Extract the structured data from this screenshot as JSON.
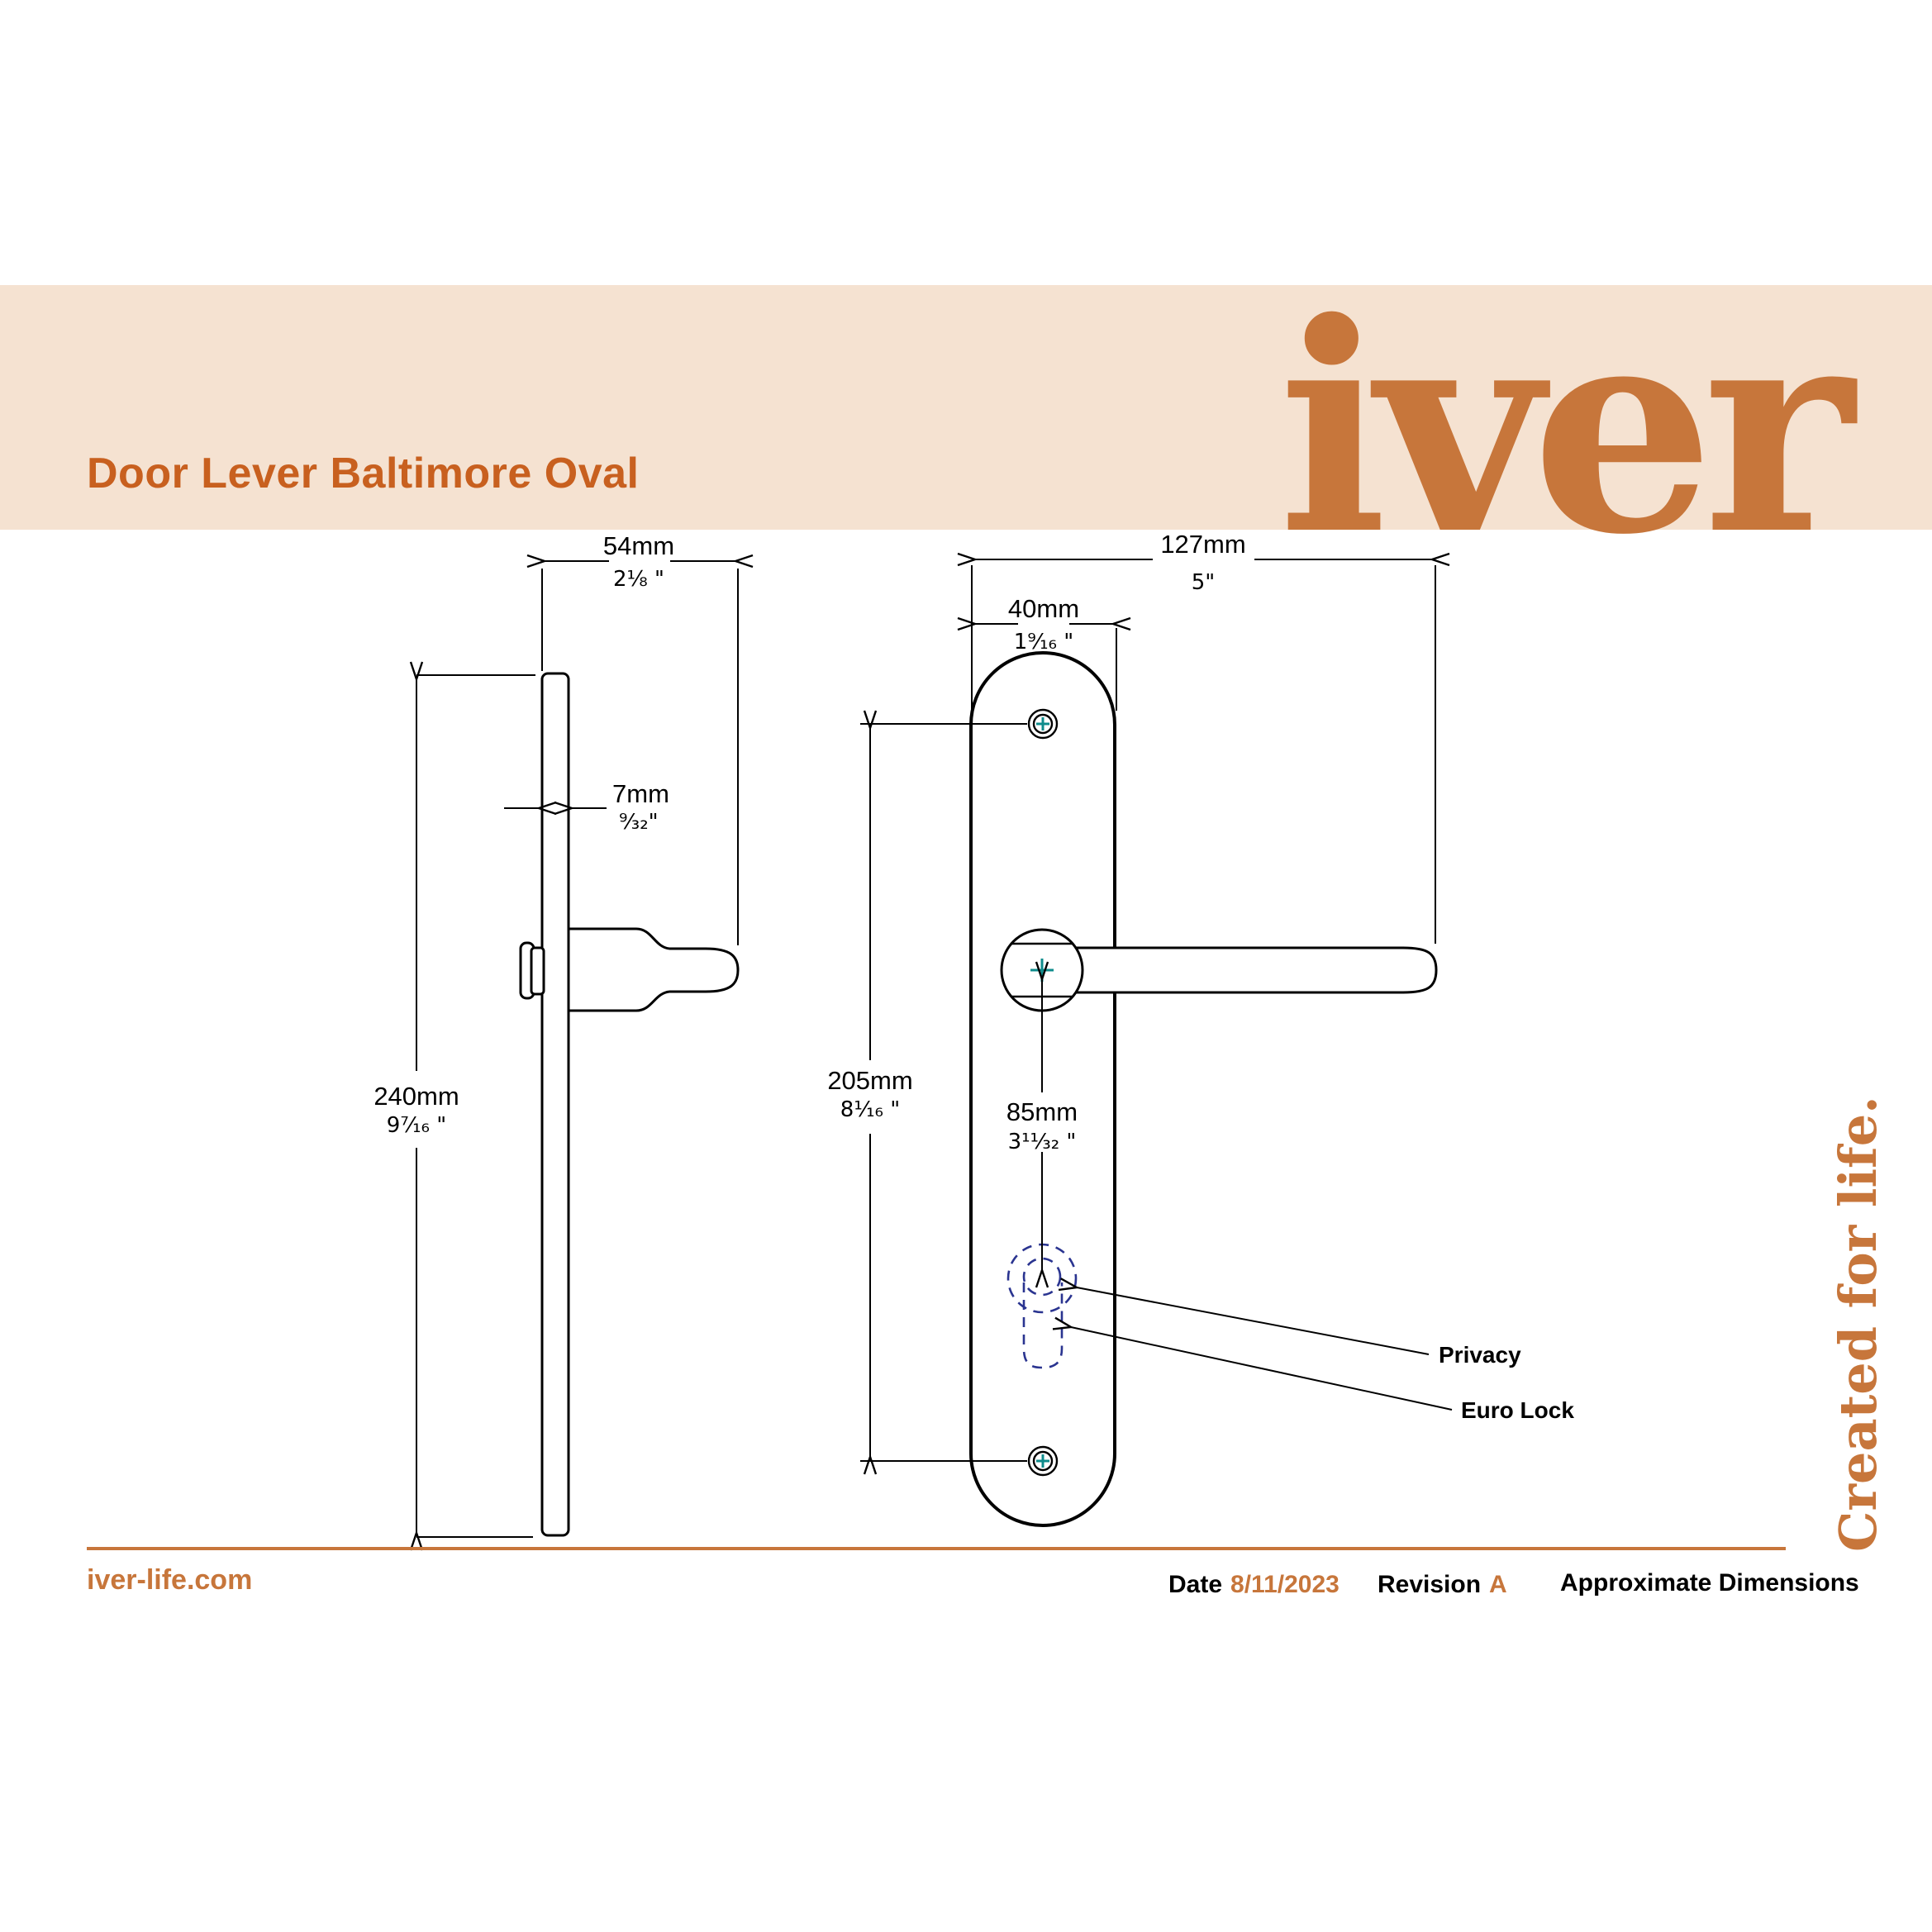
{
  "banner": {
    "title": "Door Lever Baltimore Oval",
    "logo_text": "iver"
  },
  "drawing": {
    "dimensions": {
      "side_depth": {
        "mm": "54mm",
        "inch": "2⅛ \""
      },
      "plate_thickness": {
        "mm": "7mm",
        "inch": "⁹⁄₃₂\""
      },
      "plate_height": {
        "mm": "240mm",
        "inch": "9⁷⁄₁₆ \""
      },
      "overall_width": {
        "mm": "127mm",
        "inch": "5\""
      },
      "plate_width": {
        "mm": "40mm",
        "inch": "1⁹⁄₁₆ \""
      },
      "screw_centres": {
        "mm": "205mm",
        "inch": "8¹⁄₁₆ \""
      },
      "handle_to_keyhole": {
        "mm": "85mm",
        "inch": "3¹¹⁄₃₂ \""
      }
    },
    "callouts": {
      "privacy": "Privacy",
      "euro_lock": "Euro Lock"
    }
  },
  "tagline": "Created for life.",
  "footer": {
    "website": "iver-life.com",
    "date_label": "Date",
    "date_value": "8/11/2023",
    "revision_label": "Revision",
    "revision_value": "A",
    "note": "Approximate Dimensions"
  },
  "colors": {
    "accent": "#C7763B",
    "title": "#C8601F",
    "banner_bg": "#F5E2D1",
    "screw_cross_teal": "#0F8C8C",
    "keyhole_navy": "#2A3490",
    "line": "#000000"
  }
}
